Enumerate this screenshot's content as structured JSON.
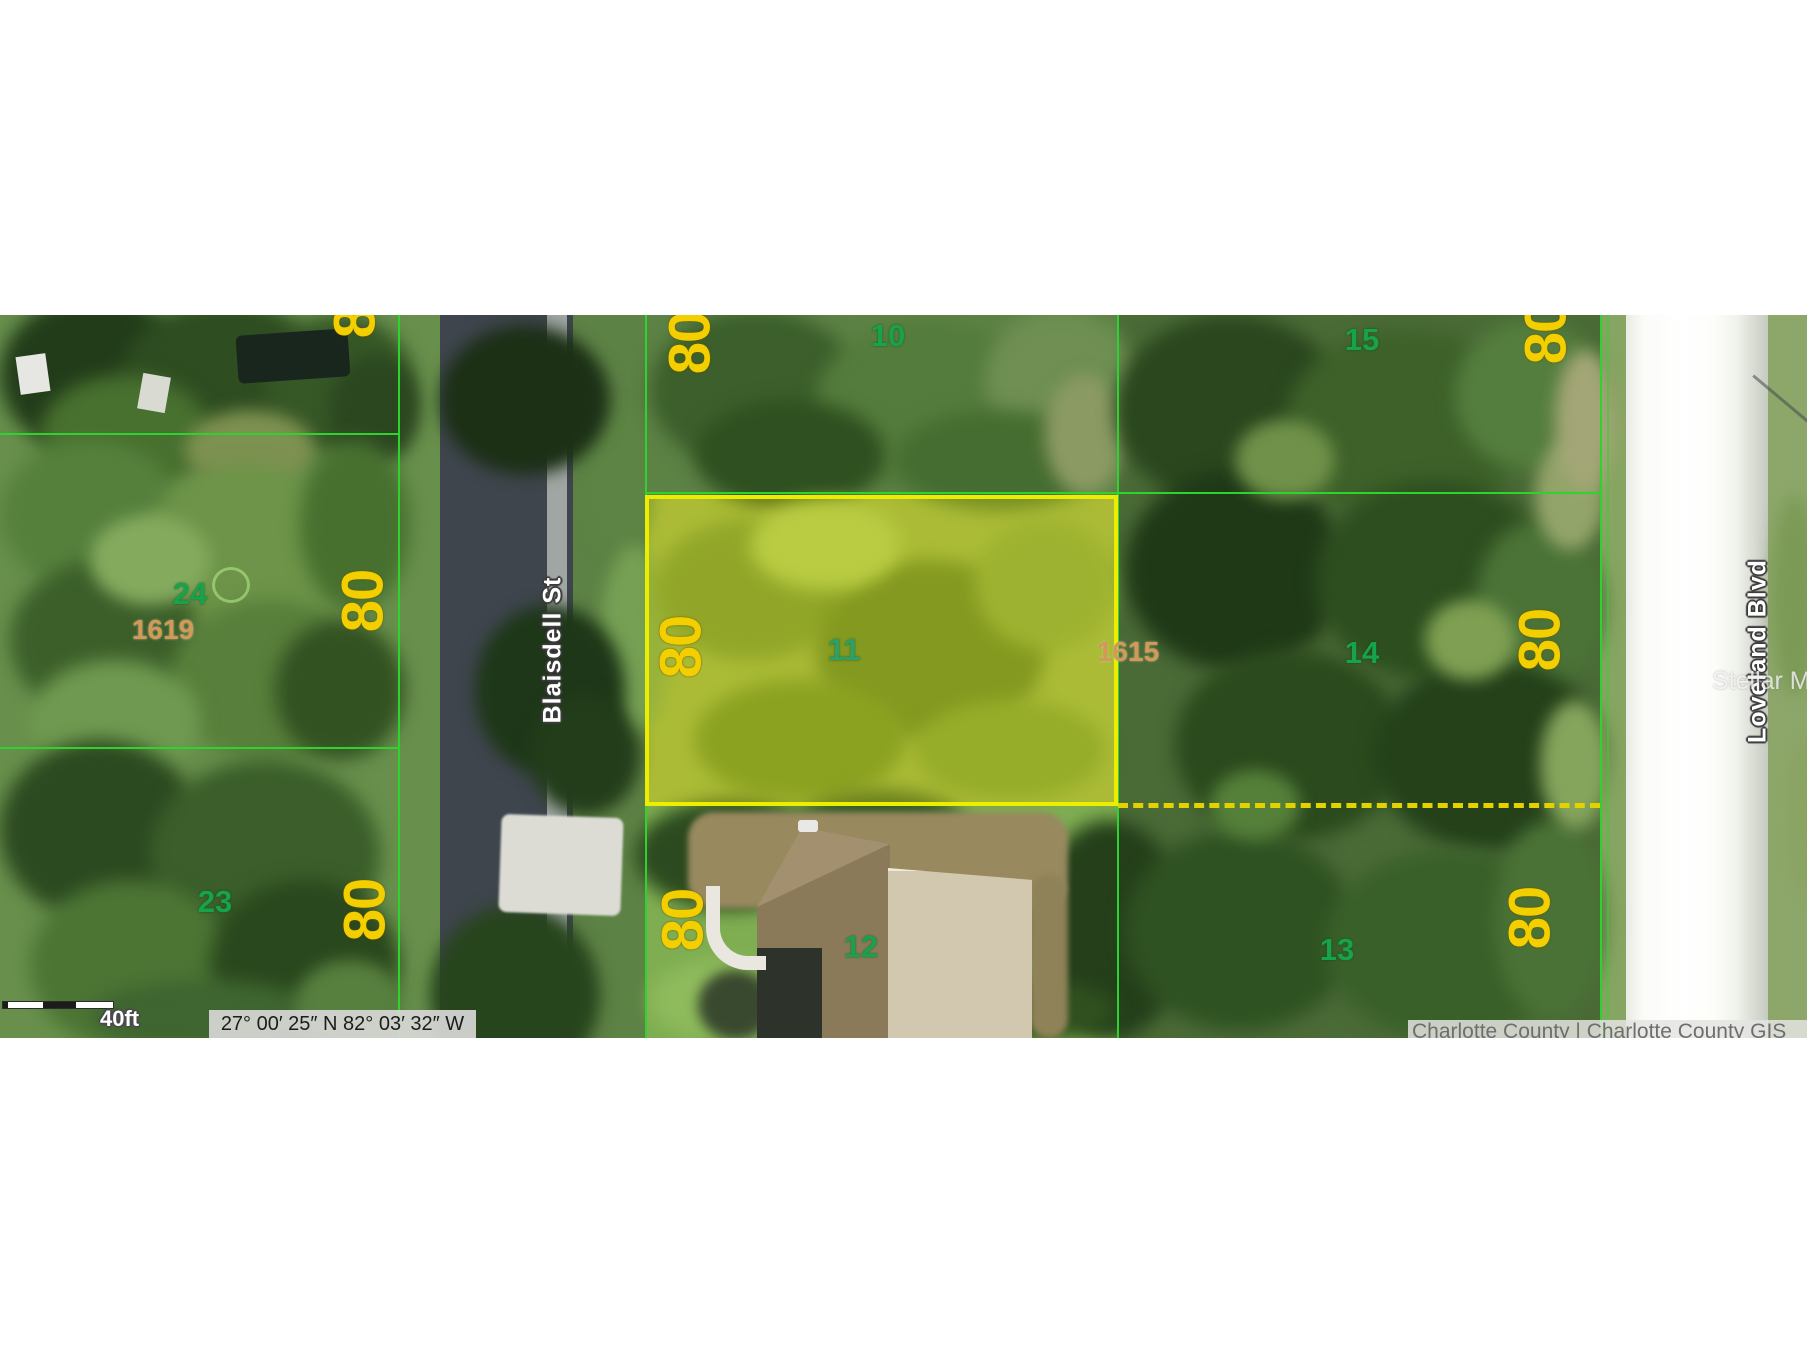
{
  "map": {
    "type": "county-gis-parcel-viewer-satellite",
    "streets": {
      "west": "Blaisdell St",
      "east": "Loveland Blvd"
    },
    "lots": {
      "lot_10": "10",
      "lot_11": "11",
      "lot_12": "12",
      "lot_13": "13",
      "lot_14": "14",
      "lot_15": "15",
      "lot_23": "23",
      "lot_24": "24"
    },
    "parcel_ids": {
      "west_block": "1619",
      "highlighted": "1615"
    },
    "dimension_label": "80",
    "dimension_labels": [
      {
        "text": "80",
        "location": "west-block-top-edge-clipped"
      },
      {
        "text": "80",
        "location": "west-block-lot-24"
      },
      {
        "text": "80",
        "location": "west-block-lot-23"
      },
      {
        "text": "80",
        "location": "middle-block-lot-10-top-clipped"
      },
      {
        "text": "80",
        "location": "middle-block-lot-11"
      },
      {
        "text": "80",
        "location": "middle-block-lot-12"
      },
      {
        "text": "80",
        "location": "east-block-lot-15-top-clipped"
      },
      {
        "text": "80",
        "location": "east-block-lot-14"
      },
      {
        "text": "80",
        "location": "east-block-lot-13"
      }
    ],
    "highlighted_parcel": {
      "lot": "11",
      "parcel_id": "1615",
      "frontage": "80",
      "boundary_style": "solid yellow with yellow tint fill",
      "south_boundary_style": "dashed yellow"
    },
    "statusbar": {
      "coordinates": "27° 00′ 25″ N 82° 03′ 32″ W",
      "scale_label": "40ft",
      "attribution": "Charlotte County | Charlotte County GIS",
      "watermark": "Stellar MLS"
    },
    "colors": {
      "parcel_line_green": "#2fd32f",
      "highlight_yellow": "#eded00",
      "dimension_yellow": "#f3cf00",
      "lot_number_green": "#17a24c",
      "parcel_id_orange": "#d29a55",
      "dashed_boundary_yellow": "#e3d100"
    }
  }
}
